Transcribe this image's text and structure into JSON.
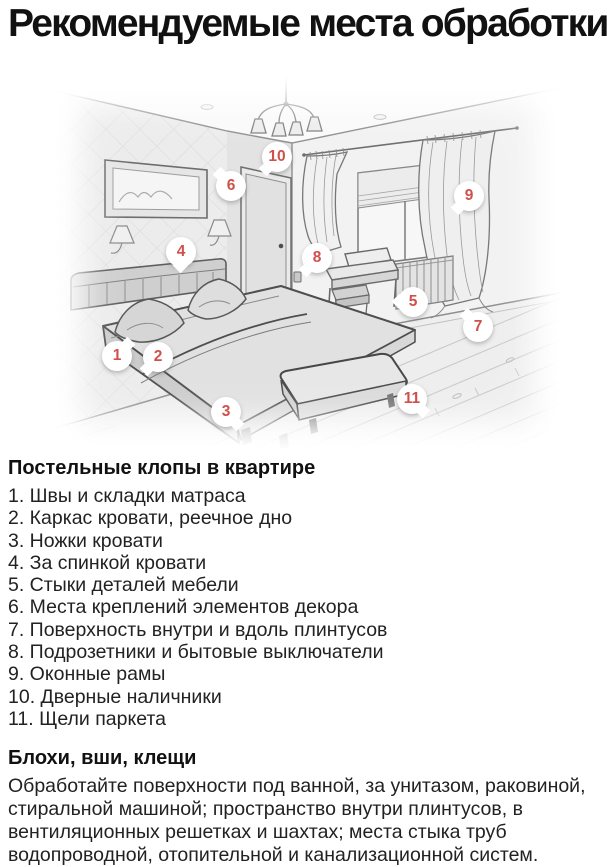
{
  "page": {
    "title": "Рекомендуемые места обработки"
  },
  "illustration": {
    "marker_color": "#cf5049",
    "markers": [
      {
        "num": "1",
        "cx": 62,
        "cy": 278,
        "tail": "tr"
      },
      {
        "num": "2",
        "cx": 103,
        "cy": 279,
        "tail": "bl"
      },
      {
        "num": "3",
        "cx": 171,
        "cy": 334,
        "tail": "br"
      },
      {
        "num": "4",
        "cx": 126,
        "cy": 174,
        "tail": "b"
      },
      {
        "num": "5",
        "cx": 358,
        "cy": 224,
        "tail": "l"
      },
      {
        "num": "6",
        "cx": 176,
        "cy": 108,
        "tail": "tl"
      },
      {
        "num": "7",
        "cx": 423,
        "cy": 249,
        "tail": "tl"
      },
      {
        "num": "8",
        "cx": 262,
        "cy": 180,
        "tail": "bl"
      },
      {
        "num": "9",
        "cx": 414,
        "cy": 118,
        "tail": "bl"
      },
      {
        "num": "10",
        "cx": 222,
        "cy": 79,
        "tail": "bl"
      },
      {
        "num": "11",
        "cx": 357,
        "cy": 321,
        "tail": "br"
      }
    ]
  },
  "lists": {
    "bedbugs": {
      "heading": "Постельные клопы в квартире",
      "items": [
        "1. Швы и складки матраса",
        "2. Каркас кровати, реечное дно",
        "3. Ножки кровати",
        "4. За спинкой кровати",
        "5. Стыки деталей мебели",
        "6. Места креплений элементов декора",
        "7. Поверхность внутри и вдоль плинтусов",
        "8. Подрозетники и бытовые выключатели",
        "9. Оконные рамы",
        "10. Дверные наличники",
        "11. Щели паркета"
      ]
    },
    "fleas": {
      "heading": "Блохи, вши, клещи",
      "paragraph": "Обработайте поверхности под ванной, за унитазом, раковиной, стиральной машиной; пространство внутри плинтусов, в вентиляционных решетках и шахтах; места стыка труб водопроводной, отопительной и канализационной систем."
    }
  }
}
